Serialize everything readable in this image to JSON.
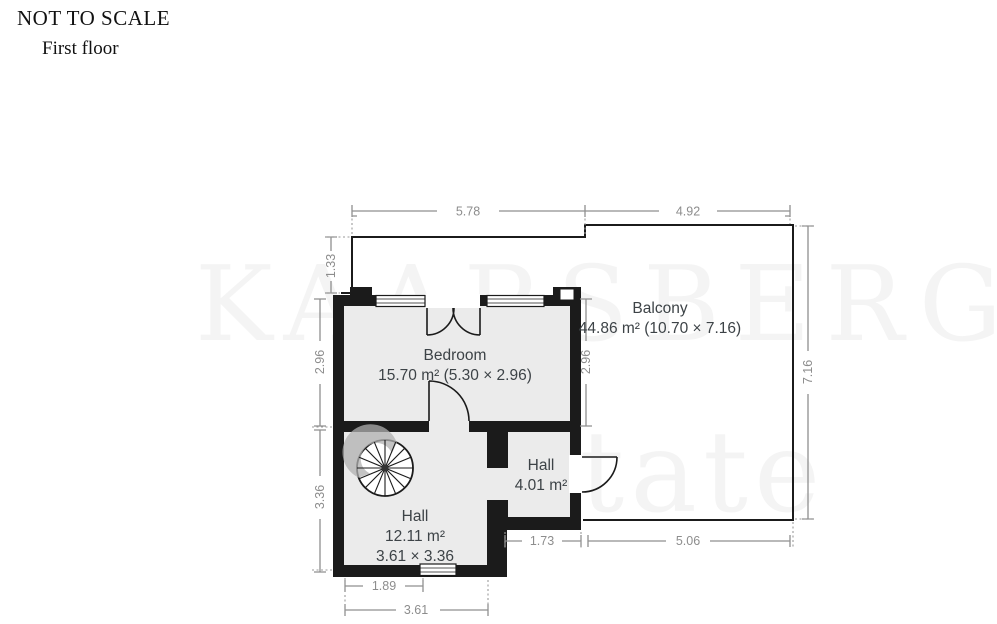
{
  "header": {
    "not_to_scale": "NOT TO SCALE",
    "floor_label": "First floor"
  },
  "watermark": {
    "line1": "KAARSBERG",
    "line2": "Estate"
  },
  "rooms": {
    "bedroom": {
      "name": "Bedroom",
      "area": "15.70 m² (5.30 × 2.96)"
    },
    "balcony": {
      "name": "Balcony",
      "area": "44.86 m² (10.70 × 7.16)"
    },
    "hall_small": {
      "name": "Hall",
      "area": "4.01 m²"
    },
    "hall_main": {
      "name": "Hall",
      "area": "12.11 m²",
      "dimensions": "3.61 × 3.36"
    }
  },
  "dimensions": {
    "top_left": "5.78",
    "top_right": "4.92",
    "balcony_left_upper": "1.33",
    "bedroom_left": "2.96",
    "hall_left": "3.36",
    "bedroom_right": "2.96",
    "balcony_right": "7.16",
    "hall_small_bottom": "1.73",
    "balcony_bottom": "5.06",
    "hall_window_bottom": "1.89",
    "hall_bottom": "3.61"
  },
  "colors": {
    "wall": "#1b1b1b",
    "room_fill": "#ebebeb",
    "dimension": "#8f8f8f",
    "label": "#3d4347"
  }
}
